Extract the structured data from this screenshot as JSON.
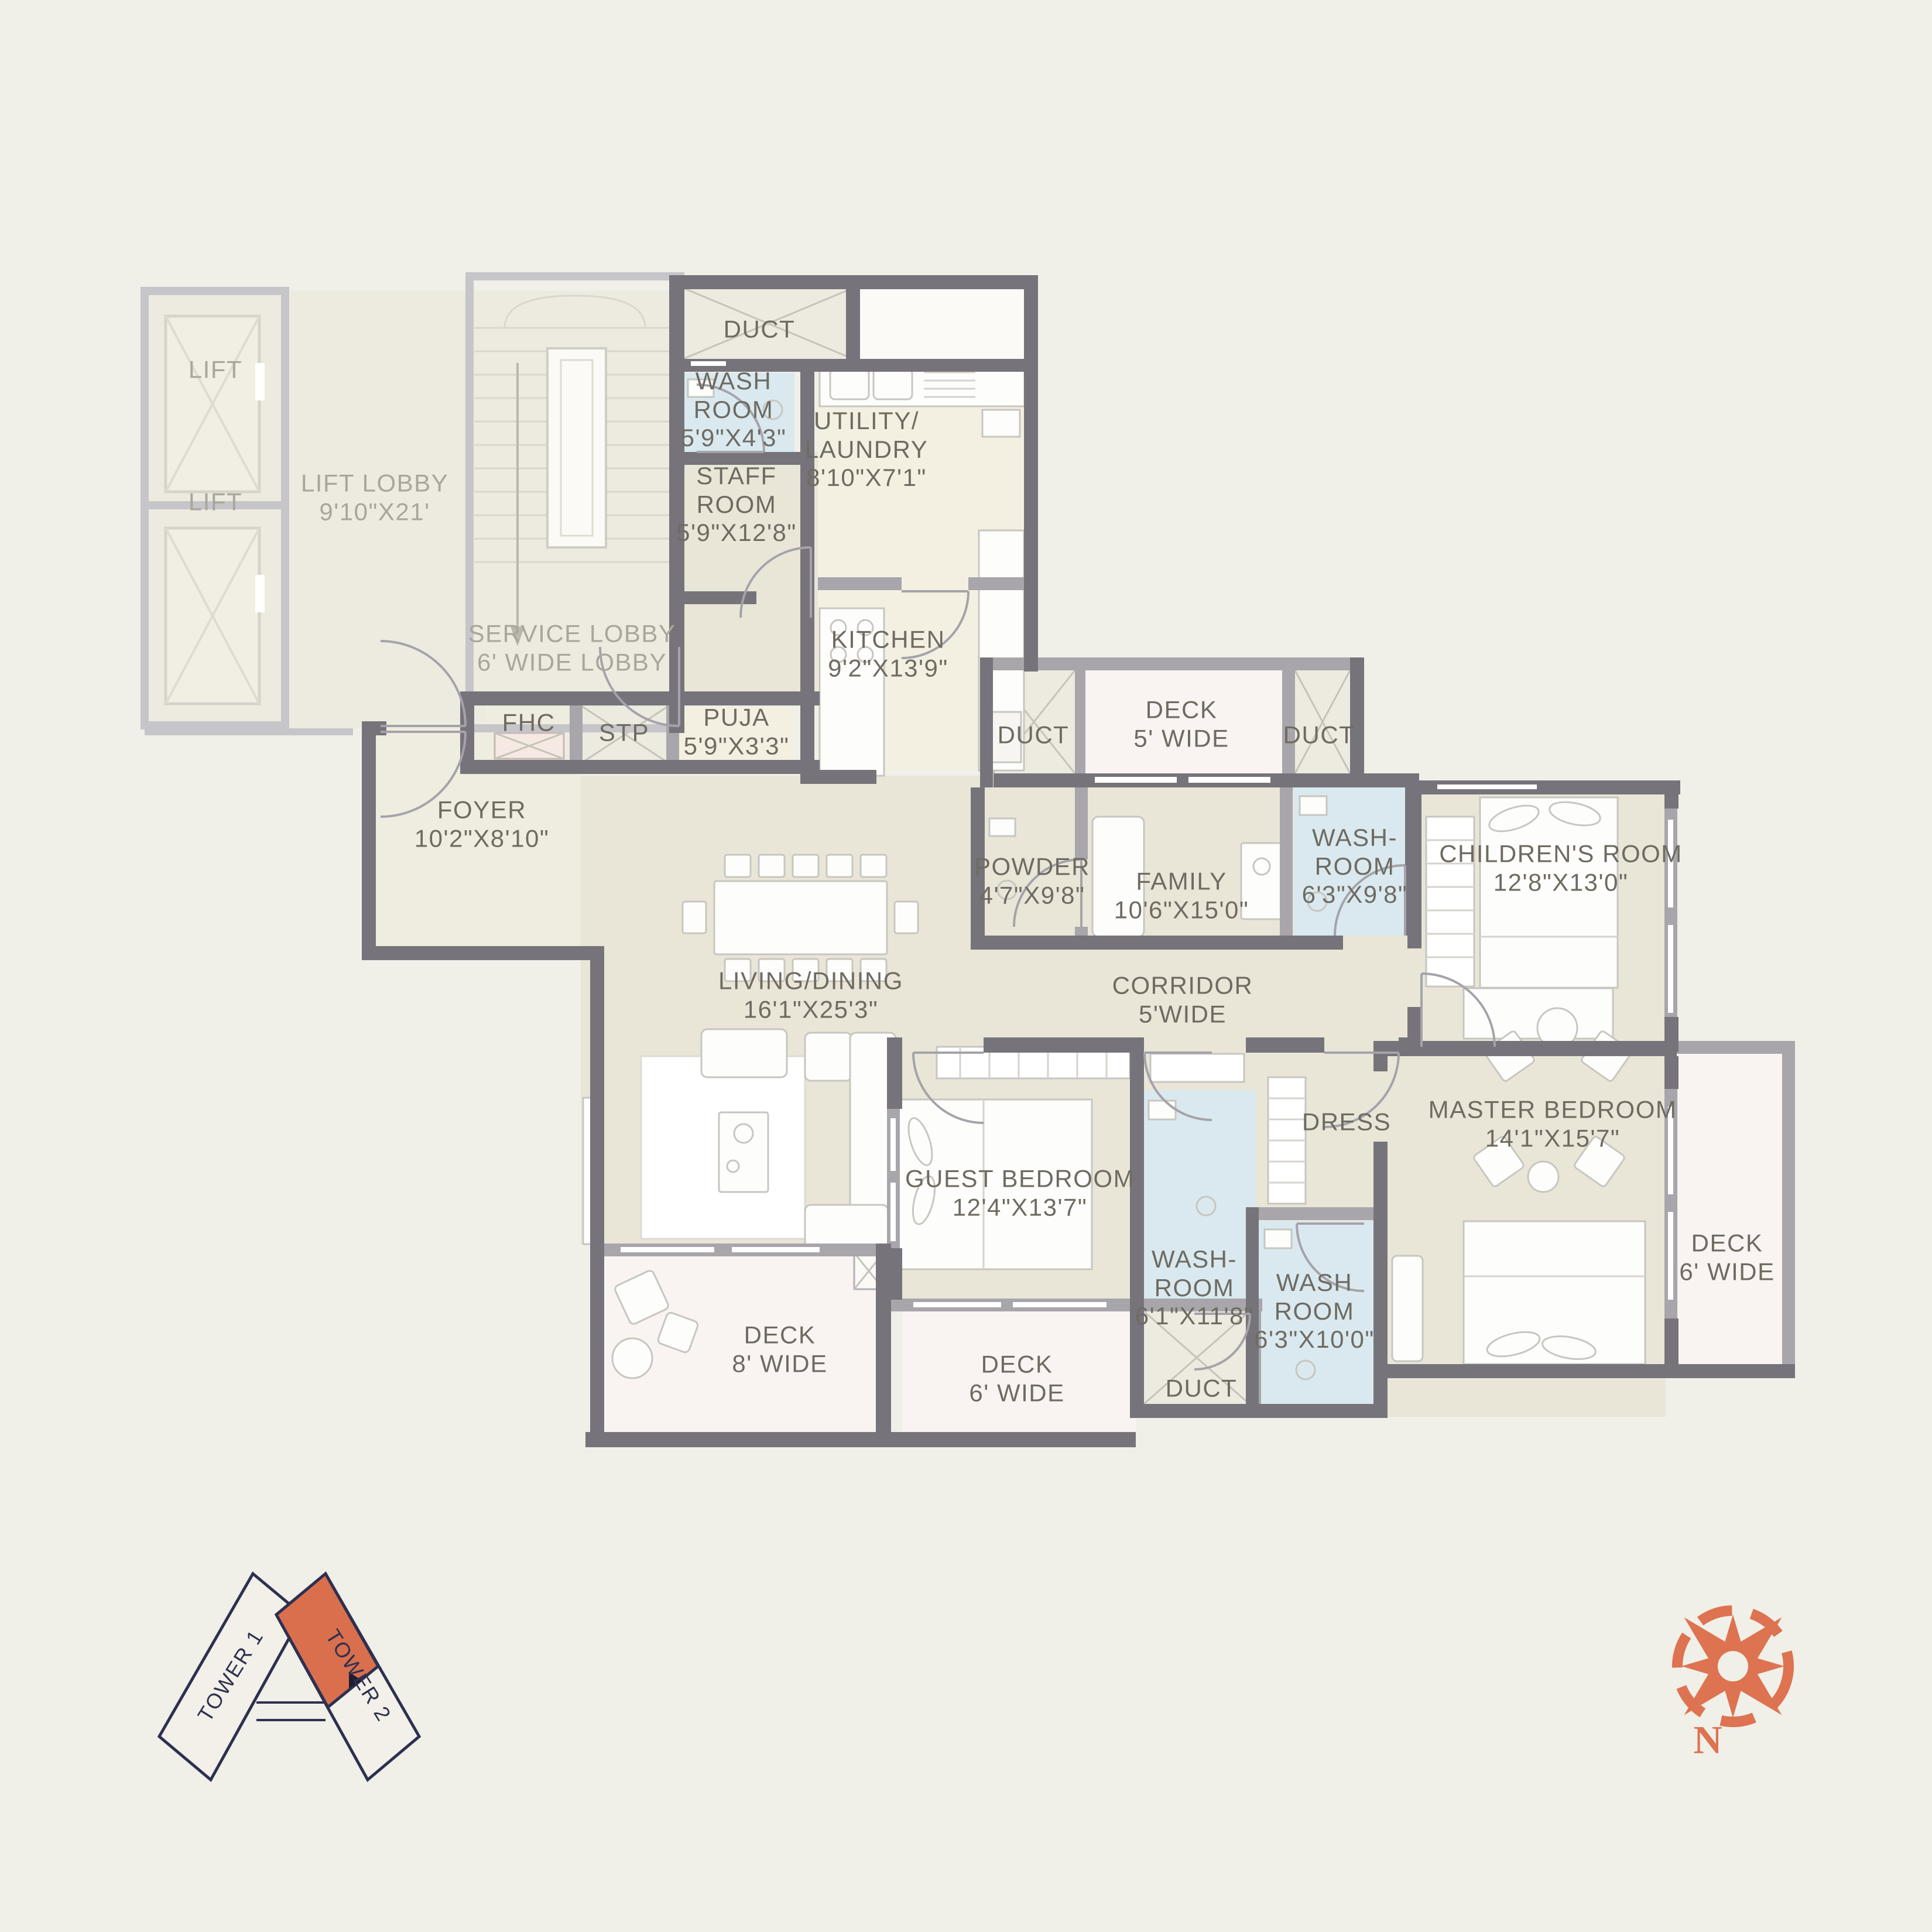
{
  "rooms": {
    "lift1": {
      "name": "LIFT"
    },
    "lift2": {
      "name": "LIFT"
    },
    "lift_lobby": {
      "name": "LIFT LOBBY",
      "dims": "9'10\"X21'"
    },
    "service_lobby": {
      "name": "SERVICE LOBBY",
      "dims": "6' WIDE LOBBY"
    },
    "duct_top": {
      "name": "DUCT"
    },
    "washroom_staff": {
      "name": "WASH\nROOM",
      "dims": "5'9\"X4'3\""
    },
    "staff_room": {
      "name": "STAFF\nROOM",
      "dims": "5'9\"X12'8\""
    },
    "utility": {
      "name": "UTILITY/\nLAUNDRY",
      "dims": "8'10\"X7'1\""
    },
    "kitchen": {
      "name": "KITCHEN",
      "dims": "9'2\"X13'9\""
    },
    "fhc": {
      "name": "FHC"
    },
    "stp": {
      "name": "STP"
    },
    "puja": {
      "name": "PUJA",
      "dims": "5'9\"X3'3\""
    },
    "foyer": {
      "name": "FOYER",
      "dims": "10'2\"X8'10\""
    },
    "duct_deck_left": {
      "name": "DUCT"
    },
    "deck_5": {
      "name": "DECK",
      "dims": "5' WIDE"
    },
    "duct_deck_right": {
      "name": "DUCT"
    },
    "powder": {
      "name": "POWDER",
      "dims": "4'7\"X9'8\""
    },
    "family": {
      "name": "FAMILY",
      "dims": "10'6\"X15'0\""
    },
    "washroom_family": {
      "name": "WASH-\nROOM",
      "dims": "6'3\"X9'8\""
    },
    "childrens_room": {
      "name": "CHILDREN'S ROOM",
      "dims": "12'8\"X13'0\""
    },
    "living_dining": {
      "name": "LIVING/DINING",
      "dims": "16'1\"X25'3\""
    },
    "corridor": {
      "name": "CORRIDOR",
      "dims": "5'WIDE"
    },
    "master_bedroom": {
      "name": "MASTER BEDROOM",
      "dims": "14'1\"X15'7\""
    },
    "deck_6_master": {
      "name": "DECK",
      "dims": "6' WIDE"
    },
    "guest_bedroom": {
      "name": "GUEST BEDROOM",
      "dims": "12'4\"X13'7\""
    },
    "washroom_guest": {
      "name": "WASH-\nROOM",
      "dims": "6'1\"X11'8\""
    },
    "dress": {
      "name": "DRESS"
    },
    "washroom_master": {
      "name": "WASH\nROOM",
      "dims": "6'3\"X10'0\""
    },
    "deck_8": {
      "name": "DECK",
      "dims": "8' WIDE"
    },
    "deck_6_guest": {
      "name": "DECK",
      "dims": "6' WIDE"
    },
    "duct_bottom": {
      "name": "DUCT"
    }
  },
  "keyplan": {
    "tower1": "TOWER 1",
    "tower2": "TOWER 2"
  },
  "compass": {
    "north": "N"
  },
  "colors": {
    "background": "#f0efe8",
    "wall_dark": "#76747a",
    "wall_medium": "#a8a6ab",
    "wall_light": "#c6c5c9",
    "floor_beige": "#e9e6d8",
    "floor_pale": "#f3f0e2",
    "floor_cream": "#efece0",
    "deck_pink": "#f9f4f2",
    "washroom_blue": "#d9e9ef",
    "duct_cream": "#edeadf",
    "text_dark": "#6f6b62",
    "text_light": "#a9a69b",
    "accent_orange": "#dd7351",
    "keyplan_navy": "#2e3050"
  }
}
